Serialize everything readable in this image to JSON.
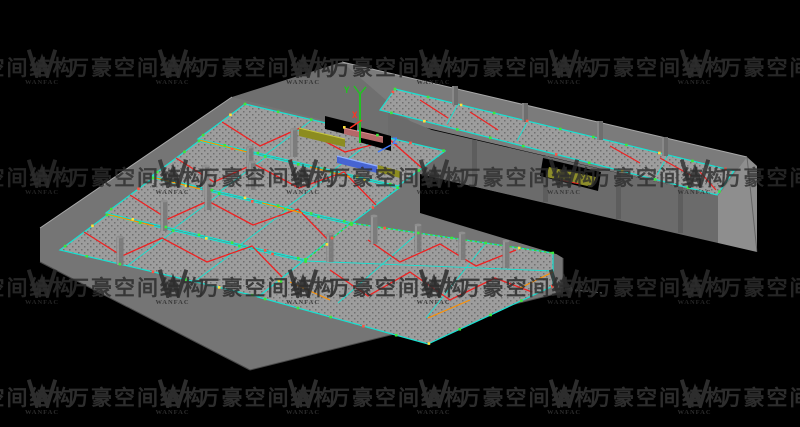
{
  "viewport": {
    "description": "3D space-frame steel structure model, isometric view, CAD viewport on black background"
  },
  "watermark": {
    "logo_letter": "W",
    "logo_caption": "WANFAC",
    "cjk_text": "万豪空间结构",
    "color": "#2d2d2d"
  },
  "axes": {
    "x_label": "X",
    "y_label": "Y",
    "z_label": "Z",
    "x_color": "#ff3322",
    "y_color": "#21c321",
    "z_color": "#3f7bff"
  },
  "palette": {
    "background": "#000000",
    "grid_edge_cyan": "#17e2d2",
    "ridge_red": "#ee2222",
    "accent_orange": "#ff9100",
    "purlin_green": "#38d438",
    "node_green": "#3ce83c",
    "node_yellow": "#ffe23c",
    "node_red": "#ff5544",
    "mesh_light": "#9d9d9d",
    "mesh_dot": "#6f6f6f",
    "wall_main": "#757575",
    "wall_dark": "#686868",
    "wall_back": "#7b7b7b",
    "wall_band": "#6f6f6f",
    "wall_light": "#8e8e8e",
    "beam_olive": "#8c8c20",
    "beam_blue": "#4664d2",
    "beam_pink": "#b46868",
    "column_gray": "#7c7c7c",
    "column_light": "#a0a0a0"
  }
}
